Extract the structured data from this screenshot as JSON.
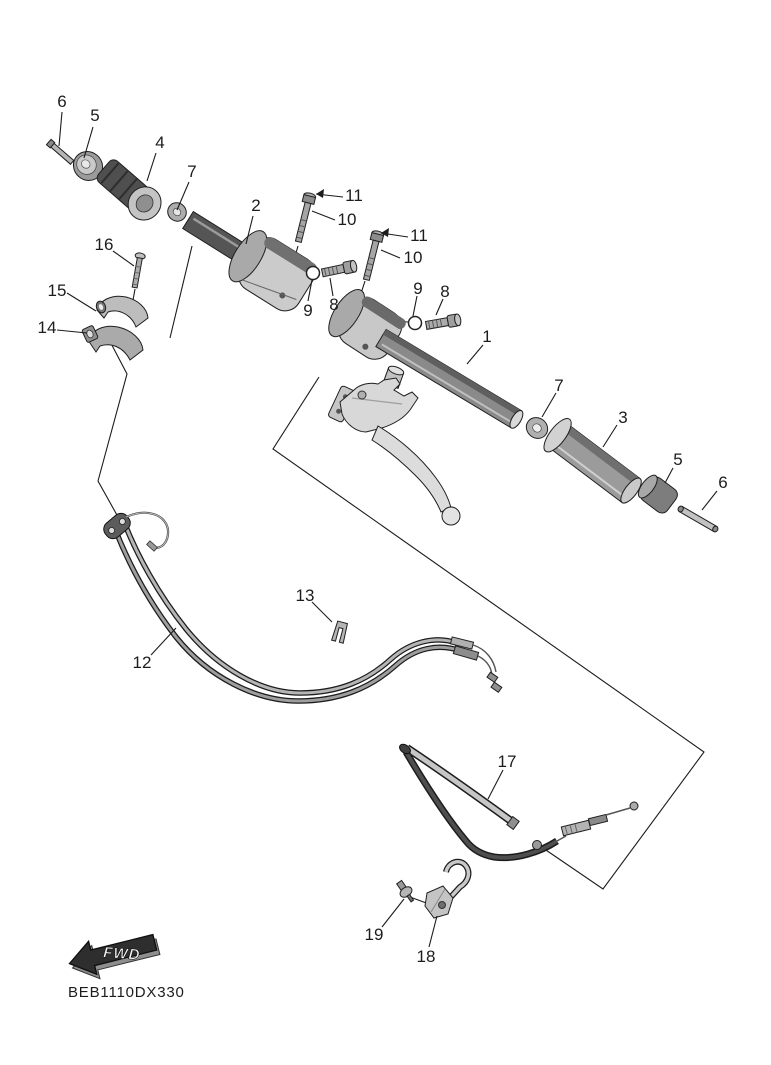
{
  "drawing": {
    "part_code": "BEB1110DX330",
    "fwd_label": "FWD",
    "diagram_title": "Steering handle exploded parts diagram"
  },
  "callouts": [
    {
      "ref": "6"
    },
    {
      "ref": "5"
    },
    {
      "ref": "4"
    },
    {
      "ref": "7"
    },
    {
      "ref": "2"
    },
    {
      "ref": "11"
    },
    {
      "ref": "10"
    },
    {
      "ref": "11"
    },
    {
      "ref": "10"
    },
    {
      "ref": "16"
    },
    {
      "ref": "15"
    },
    {
      "ref": "14"
    },
    {
      "ref": "9"
    },
    {
      "ref": "8"
    },
    {
      "ref": "9"
    },
    {
      "ref": "8"
    },
    {
      "ref": "1"
    },
    {
      "ref": "7"
    },
    {
      "ref": "3"
    },
    {
      "ref": "5"
    },
    {
      "ref": "6"
    },
    {
      "ref": "12"
    },
    {
      "ref": "13"
    },
    {
      "ref": "17"
    },
    {
      "ref": "19"
    },
    {
      "ref": "18"
    }
  ],
  "colors": {
    "background": "#ffffff",
    "line": "#1c1c1c",
    "part_dark": "#4f4f4f",
    "part_mid": "#9b9b9b",
    "part_light": "#cdcdcd"
  }
}
